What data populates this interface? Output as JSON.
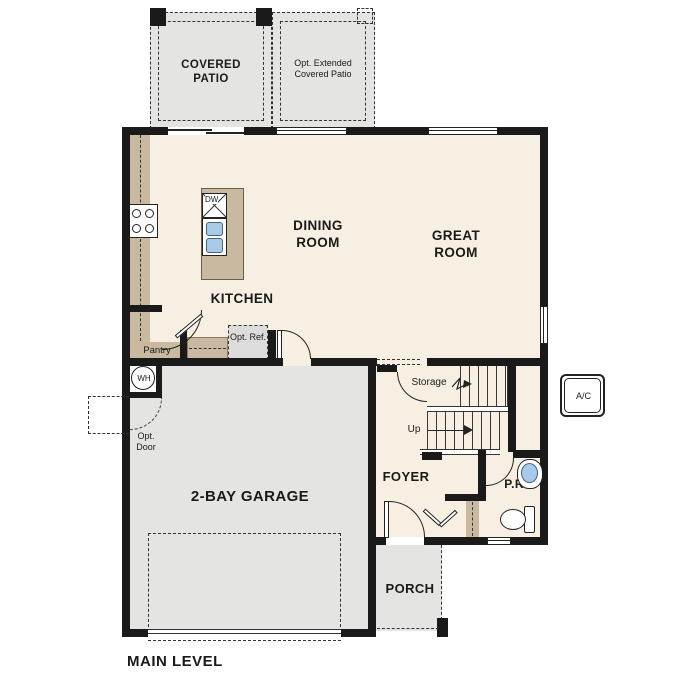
{
  "title": "MAIN LEVEL",
  "colors": {
    "wall": "#1a1a1a",
    "floor_living": "#f6efe2",
    "floor_concrete": "#e4e4e2",
    "cabinet_tan": "#c9b9a0",
    "fixture_blue": "#a9c9e9",
    "optbox": "#dcdcdc"
  },
  "rooms": {
    "dining": "DINING ROOM",
    "great": "GREAT ROOM",
    "kitchen": "KITCHEN",
    "foyer": "FOYER",
    "powder": "P.R.",
    "garage": "2-BAY GARAGE",
    "porch": "PORCH",
    "pantry": "Pantry",
    "storage": "Storage"
  },
  "outdoor": {
    "covered_patio": "COVERED PATIO",
    "opt_extended_patio": "Opt. Extended Covered Patio"
  },
  "annotations": {
    "up": "Up",
    "opt_ref": "Opt. Ref.",
    "opt_door": "Opt. Door",
    "water_heater": "WH",
    "ac": "A/C",
    "dishwasher": "DW"
  }
}
